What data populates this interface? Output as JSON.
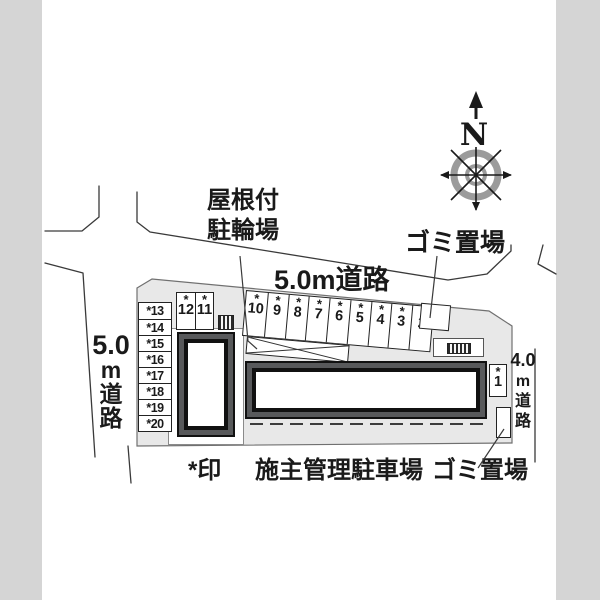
{
  "labels": {
    "bicycle_line1": "屋根付",
    "bicycle_line2": "駐輪場",
    "road_top": "5.0m道路",
    "garbage_top": "ゴミ置場",
    "road_left_size": "5.0",
    "road_left_c1": "m",
    "road_left_c2": "道",
    "road_left_c3": "路",
    "road_right_size": "4.0",
    "road_right_c1": "m",
    "road_right_c2": "道",
    "road_right_c3": "路",
    "compass_north": "N"
  },
  "legend": {
    "mark": "*印",
    "managed_parking": "施主管理駐車場",
    "garbage": "ゴミ置場"
  },
  "parking": {
    "star_mark": "*",
    "left_column": [
      "*13",
      "*14",
      "*15",
      "*16",
      "*17",
      "*18",
      "*19",
      "*20"
    ],
    "pair": [
      "12",
      "11"
    ],
    "top_row": [
      "10",
      "9",
      "8",
      "7",
      "6",
      "5",
      "4",
      "3",
      "2"
    ],
    "east_spot": "1"
  },
  "colors": {
    "site_fill": "#e8e8e8",
    "building_band": "#58595b",
    "building_line": "#111111",
    "road_line": "#3a3a3a",
    "side_band": "#d5d5d5",
    "compass_ring": "#9b9b9b"
  }
}
